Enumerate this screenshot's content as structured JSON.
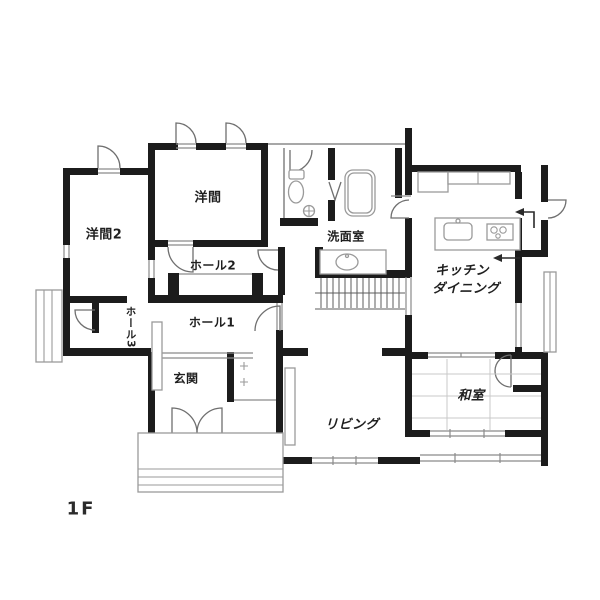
{
  "floor_plan": {
    "floor_label": "1F",
    "rooms": {
      "youma": "洋間",
      "youma2": "洋間2",
      "hall2": "ホール2",
      "hall1": "ホール1",
      "hall3": "ホール3",
      "senmenshitsu": "洗面室",
      "kitchen_line1": "キッチン",
      "kitchen_line2": "ダイニング",
      "genkan": "玄関",
      "living": "リビング",
      "washitsu": "和室"
    },
    "colors": {
      "wall": "#1c1c1c",
      "thin_line": "#8a8a8a",
      "fixture": "#9a9a9a",
      "background": "#ffffff",
      "label": "#1f1f1f"
    }
  }
}
